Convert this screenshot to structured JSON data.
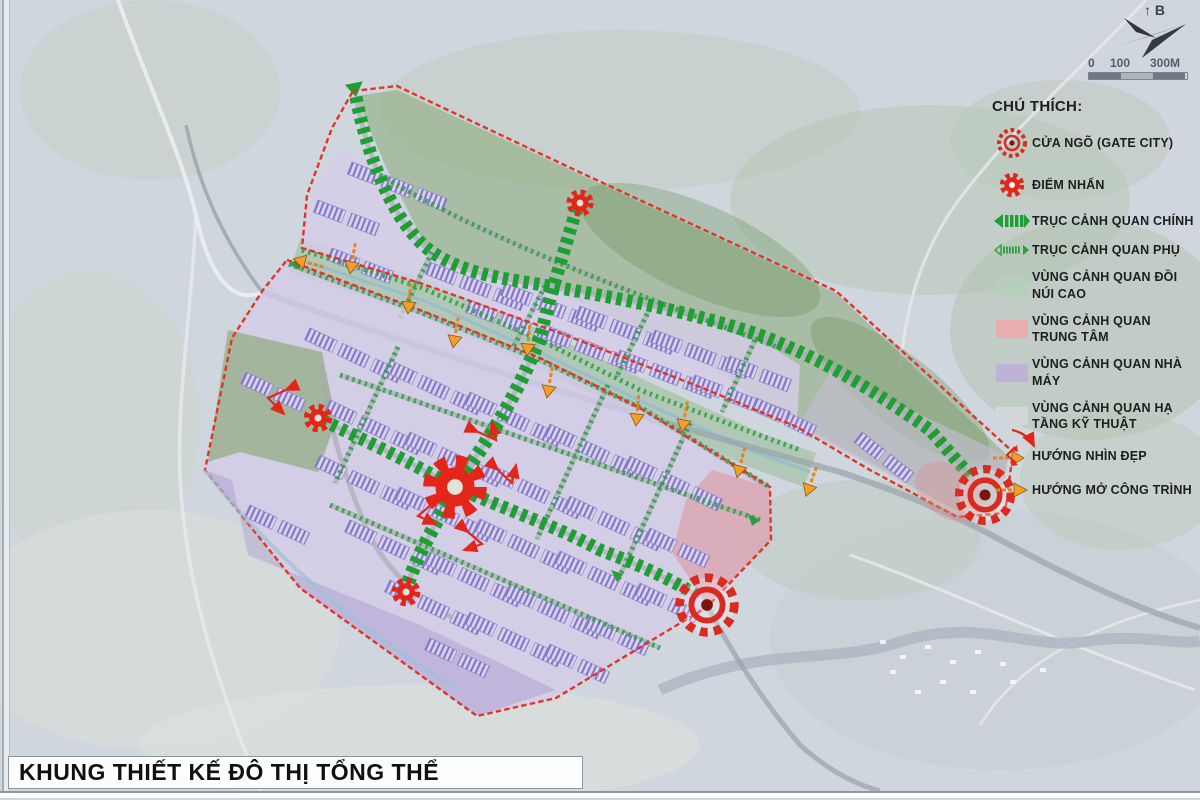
{
  "title": "KHUNG THIẾT KẾ ĐÔ THỊ TỔNG THỂ",
  "legend": {
    "header": "CHÚ THÍCH:",
    "items": [
      {
        "icon": "gate-city-icon",
        "label": "CỬA NGÕ (GATE CITY)"
      },
      {
        "icon": "focal-point-icon",
        "label": "ĐIỂM NHẤN"
      },
      {
        "icon": "main-axis-icon",
        "label": "TRỤC CẢNH QUAN CHÍNH"
      },
      {
        "icon": "sub-axis-icon",
        "label": "TRỤC CẢNH QUAN PHỤ"
      },
      {
        "icon": "zone-swatch",
        "label": "VÙNG CẢNH QUAN ĐỒI NÚI CAO",
        "color": "#b7ceba"
      },
      {
        "icon": "zone-swatch",
        "label": "VÙNG CẢNH QUAN TRUNG TÂM",
        "color": "#e9adad"
      },
      {
        "icon": "zone-swatch",
        "label": "VÙNG CẢNH QUAN NHÀ MÁY",
        "color": "#beb3d7"
      },
      {
        "icon": "zone-swatch",
        "label": "VÙNG CẢNH QUAN HẠ TẦNG KỸ THUẬT",
        "color": "#d4d7da"
      },
      {
        "icon": "view-direction-icon",
        "label": "HƯỚNG NHÌN ĐẸP"
      },
      {
        "icon": "opening-direction-icon",
        "label": "HƯỚNG MỞ CÔNG TRÌNH"
      }
    ]
  },
  "compass": {
    "north_label": "B"
  },
  "scale_bar": {
    "ticks": [
      "0",
      "100",
      "300M"
    ]
  },
  "colors": {
    "map_background": "#cfd6dd",
    "main_axis_green": "#1f9f33",
    "boundary_red": "#df3627",
    "accent_red": "#e2261a",
    "open_arrow_orange": "#f59d28",
    "factory_purple": "#8175c8"
  }
}
